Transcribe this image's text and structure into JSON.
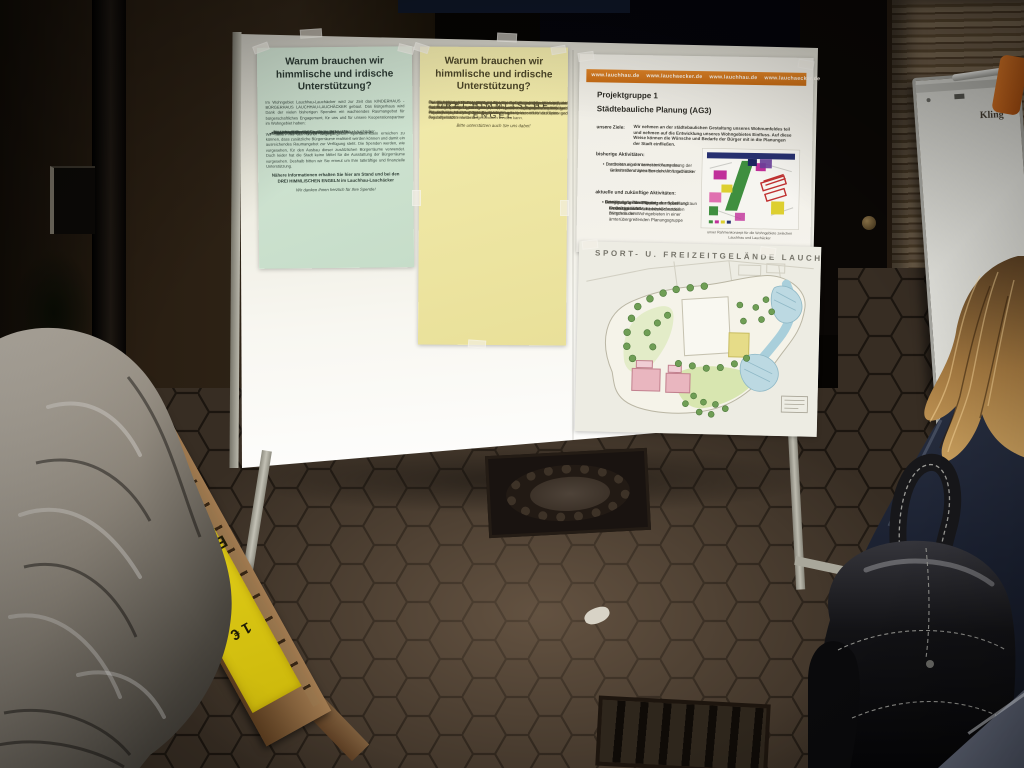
{
  "scene": {
    "description": "Nighttime flash photograph: information display board with community posters on a paved square, two people in foreground",
    "colors": {
      "night": "#070503",
      "board_white": "#f2f1ea",
      "poster_green": "#cfe2d0",
      "poster_yellow": "#efe8a6",
      "poster_white": "#f0eee6",
      "orange_bar": "#d97a20",
      "sign_yellow": "#e5d11c",
      "ground": "#372d23"
    }
  },
  "board": {
    "poster_green": {
      "title": "Warum brauchen wir himmlische und irdische Unterstützung?",
      "intro": "Im Wohngebiet Lauchhau-Lauchäcker wird zur Zeit das KINDERHAUS - BÜRGERHAUS LAUCHHAU-LAUCHÄCKER gebaut. Das Bürgerhaus wird Dank der vielen bisherigen Spenden ein wachsendes Raumangebot für bürgerschaftliches Engagement, für uns und für unsere Kooperationspartner im Wohngebiet haben:",
      "partners": [
        "KITAL",
        "Elternseminar",
        "Sensibelschule",
        "Seniorenarbeit",
        "Gemeinwesenarbeit Lauchhau-Lauchäcker",
        "Paulinenpflege - Stiftung Jugendhilfe aktiv",
        "Jugend und Soziale Stadtteilarbeit Lauchhau-Lauchäcker",
        "Kinderhaus Konrast",
        "Jugendtreff Lauchhau",
        "International Baptist Church Stuttgart"
      ],
      "beneficiaries": [
        "für alle Bewohner des Wohngebiets",
        "und für uns, das Bürgerforum Lauchhau-Lauchäcker e.V."
      ],
      "appeal": "Wir hoffen mit den bisher eingegangenen Spendenmitteln erreichen zu können, dass zusätzliche Bürgerräume realisiert werden können und damit ein ausreichendes Raumangebot zur Verfügung steht. Die Spenden werden, wie vorgesehen, für den Ausbau dieser zusätzlichen Bürgerräume verwendet. Doch leider hat die Stadt keine Mittel für die Ausstattung der Bürgerräume vorgesehen. Deshalb bitten wir Sie erneut um Ihre tatkräftige und finanzielle Unterstützung.",
      "info": "Nähere Informationen erhalten Sie hier am Stand und bei den DREI HIMMLISCHEN ENGELN im Lauchhau-Lauchäcker",
      "closing": "Wir danken Ihnen herzlich für Ihre Spende!"
    },
    "poster_yellow": {
      "title": "Warum brauchen wir himmlische und irdische Unterstützung?",
      "paragraphs": [
        "Die Stadt Stuttgart hat in Vaihingen West an der Katzenbachstraße ein Sport- und Freizeitgelände im Bebauungsplan vorgesehen.",
        "Eine gemeinsame Planungsgruppe aus Vereinen, städtischen Behörden und dem Bürgerforum hat den Bedarf an Sporteinrichtungen im Bezirk Vaihingen erhoben und auf dieser Grundlage den Gestaltungsentwurf für das Sport- und Freizeitgelände entwickelt.",
        "Das Sportgelände soll ein Fußballfeld und ein Kleinspielfeld mit Rasenfläche und Flutlicht erhalten. Daneben sind Spielbereiche für Familien, Senioren und Jugendliche sowie Wege und Treffpunkte vorgesehen.",
        "Gebaut wird mit den Sportanlagen auch ein Gelände mit Wiesen zum Toben und Verweilen, Spielgeräten, einer Laufstrecke, einer Bocciabahn und einem Fahrradtrail in Richtung Vaihingen/Büsnau.",
        "Für eine weitere Ausbaustufe ist auch eine Sporthalle vorgesehen, die das gesamte Freizeitgelände für Schulen und Vereine nutzbar machen würde.",
        "Bei den Haushaltsberatungen im Jahre 2003 wurde der Bau der Anlage auf die weitere Finanzplanung verschoben. Der Gemeinderat hat jedoch Planungsmittel eingestellt, so dass das Projekt in den Haushaltsberatungen des Jahres 2005 wieder aufgenommen werden kann.",
        "Es ist allgemein bekannt, dass die bestehenden Vaihinger Sportanlagen den wachsenden Bedarf nicht mehr abdecken können, und gegenseitig verlagern sich Beiträge für den Trainings- und Spielbetrieb, besonders im Kinder- und Jugendbereich.",
        "Die Erstellung des geplanten Sport- und Freizeitgeländes an der Katzenbachstraße kann diese unerfreuliche Situation entscheidend entspannen.",
        "Das Bürgerforum Lauchhau-Lauchäcker e.V. ist bereit, zusammen mit dem 1. FC Lauchhau 04 und gleichgesinnten weiteren Interessierten eine Initiative zur Verwirklichung des Geländes zu gründen."
      ],
      "signature": "DREI HIMMLISCHE ENGEL",
      "closing": "Bitte unterstützen auch Sie uns dabei!"
    },
    "poster_project": {
      "url_bar": "www.lauchhau.de    www.lauchaecker.de    www.lauchhau.de    www.lauchaecker.de",
      "heading": "Projektgruppe 1",
      "subheading": "Städtebauliche Planung (AG3)",
      "goals_label": "unsere Ziele:",
      "goals": "Wir nehmen an der städtebaulichen Gestaltung unseres Wohnumfeldes teil und nehmen auf die Entwicklung unseres Wohngebietes Einfluss. Auf diese Weise können die Wünsche und Bedarfe der Bürger mit in die Planungen der Stadt einfließen.",
      "past_label": "bisherige Aktivitäten:",
      "past_items": [
        "Durchsetzung der korrekten Ausweisung der verkehrsberuhigten Bereiche im Lauchäcker",
        "Erarbeiten einer Interessenlösung des Grünstreifens zwischen den Wohngebieten"
      ],
      "current_label": "aktuelle und zukünftige Aktivitäten:",
      "current_items": [
        "Beteiligung bei der Planung der neuen Kindertagesstätte mit ausreichenden Bürgerräumen",
        "Gemeinsame Planung der Gemeinbedarfsflächen im Grünstreifen zwischen den Wohngebieten in einer ämterübergreifenden Planungsgruppe",
        "Mitwirkung bei der Planung des Sport- und Freizeitgeländes Lauchäcker",
        "Fertigstellung des Bolzplatzes mit Ballfangzaun im Grünstreifen"
      ],
      "map_caption": "unser Rahmenkonzept für die Wohngebiete zwischen Lauchhau und Lauchäcker"
    },
    "poster_siteplan": {
      "title": "SPORT- U. FREIZEITGELÄNDE LAUCHÄCKER"
    }
  },
  "easel_sign": {
    "product": "Eintopf",
    "price": "1 €"
  },
  "flipchart": {
    "label": "Kling"
  }
}
